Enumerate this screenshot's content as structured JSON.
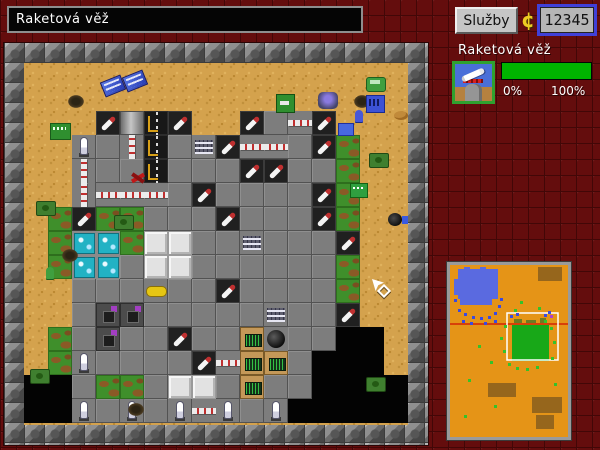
{
  "topbar": {
    "title_field": "Raketová věž",
    "services_button": "Služby",
    "coin_symbol": "¢",
    "money": "12345"
  },
  "panel": {
    "title": "Raketová věž",
    "icon": "missile-tower-icon",
    "progress_percent": 100,
    "progress_min_label": "0%",
    "progress_max_label": "100%",
    "bar_color": "#00b400"
  },
  "colors": {
    "background_brick": "#640d0d",
    "frame_block": "#8a8a8a",
    "sand": "#d4a24d",
    "money_border": "#4040d8",
    "icon_border": "#2fa12f",
    "minimap_ground": "#e59417",
    "minimap_water": "#5a6ae0",
    "minimap_zone": "#18a818",
    "minimap_line": "#d84008"
  },
  "map": {
    "tile_size": 24,
    "legend": {
      "g": "plate",
      "t": "turret",
      "m": "missile",
      "c": "camo",
      "v": "void",
      "f": "building-white",
      "F": "machine",
      "r": "runway",
      "p": "pipe-vertical",
      "P": "pipe-horizontal",
      "b": "console-blue",
      "w": "lab-cyan",
      "y": "vehicle-yellow",
      "T": "garage",
      "e": "control-panel",
      "o": "generator",
      "u": "barracks",
      "h": "manhole"
    },
    "rows": [
      "................",
      "................",
      "...tFrt..tgPt...",
      "..mgprgutPPgtc..",
      "..pggrgggttggc..",
      "..pPPPgtggggtc..",
      ".ctccgggtgggtc.h",
      ".cwwcffggugggt..",
      ".cwwgffggggggc..",
      "..gggyggtggggc..",
      "..gTTggggguggt..",
      ".cgTggtggeoggvv.",
      ".cmggggtPeegvvv.",
      "vvgccgffgeggvvvv",
      "vvmgmgmPmgmvvvvv"
    ],
    "sprites": [
      {
        "t": "crate",
        "x": 78,
        "y": 15
      },
      {
        "t": "crate",
        "x": 100,
        "y": 10
      },
      {
        "t": "shrub",
        "x": 44,
        "y": 32
      },
      {
        "t": "shrub",
        "x": 330,
        "y": 32
      },
      {
        "t": "shrub",
        "x": 38,
        "y": 186
      },
      {
        "t": "shrub",
        "x": 104,
        "y": 340
      },
      {
        "t": "bunker",
        "x": 26,
        "y": 60
      },
      {
        "t": "flag",
        "x": 252,
        "y": 31
      },
      {
        "t": "mech",
        "x": 294,
        "y": 29
      },
      {
        "t": "bldg",
        "x": 342,
        "y": 32
      },
      {
        "t": "truck",
        "x": 342,
        "y": 14
      },
      {
        "t": "soldier-blue",
        "x": 331,
        "y": 47
      },
      {
        "t": "vehicle-blue",
        "x": 314,
        "y": 60
      },
      {
        "t": "tank",
        "x": 345,
        "y": 90
      },
      {
        "t": "tank",
        "x": 12,
        "y": 138
      },
      {
        "t": "tank",
        "x": 90,
        "y": 152
      },
      {
        "t": "tank",
        "x": 342,
        "y": 314
      },
      {
        "t": "tank",
        "x": 6,
        "y": 306
      },
      {
        "t": "box",
        "x": 326,
        "y": 120
      },
      {
        "t": "dune",
        "x": 370,
        "y": 48
      },
      {
        "t": "bird",
        "x": 106,
        "y": 108
      },
      {
        "t": "soldier-green",
        "x": 22,
        "y": 204
      },
      {
        "t": "cursor",
        "x": 348,
        "y": 216
      }
    ]
  },
  "minimap": {
    "width": 118,
    "height": 172,
    "ground": "#e59417",
    "water_color": "#5a6ae0",
    "water_rects": [
      [
        8,
        4,
        40,
        30
      ],
      [
        10,
        34,
        32,
        6
      ],
      [
        4,
        14,
        4,
        16
      ],
      [
        14,
        2,
        6,
        4
      ],
      [
        30,
        2,
        6,
        4
      ]
    ],
    "patch_color": "#96661c",
    "patches": [
      [
        88,
        2,
        24,
        14
      ],
      [
        38,
        118,
        28,
        14
      ],
      [
        82,
        132,
        30,
        16
      ],
      [
        86,
        150,
        18,
        14
      ]
    ],
    "line_color": "#d84008",
    "line_y": 59,
    "viewport": {
      "x": 57,
      "y": 48,
      "w": 51,
      "h": 47
    },
    "zone": {
      "x": 62,
      "y": 58,
      "w": 37,
      "h": 38,
      "color": "#18a818"
    },
    "zone_fringe": [
      [
        64,
        54,
        8,
        4
      ],
      [
        76,
        55,
        10,
        3
      ],
      [
        90,
        53,
        6,
        5
      ]
    ],
    "green_dots": [
      [
        54,
        60
      ],
      [
        50,
        72
      ],
      [
        53,
        85
      ],
      [
        58,
        98
      ],
      [
        66,
        102
      ],
      [
        76,
        103
      ],
      [
        86,
        101
      ],
      [
        100,
        62
      ],
      [
        103,
        76
      ],
      [
        101,
        92
      ],
      [
        64,
        44
      ],
      [
        88,
        42
      ],
      [
        28,
        80
      ],
      [
        18,
        114
      ],
      [
        44,
        140
      ],
      [
        104,
        118
      ],
      [
        14,
        150
      ],
      [
        70,
        36
      ],
      [
        94,
        55
      ],
      [
        40,
        96
      ]
    ],
    "blue_dots": [
      [
        8,
        44
      ],
      [
        14,
        48
      ],
      [
        22,
        51
      ],
      [
        30,
        52
      ],
      [
        38,
        51
      ],
      [
        44,
        47
      ],
      [
        48,
        40
      ],
      [
        4,
        34
      ],
      [
        12,
        55
      ],
      [
        20,
        57
      ],
      [
        34,
        57
      ],
      [
        44,
        55
      ],
      [
        50,
        33
      ],
      [
        60,
        50
      ],
      [
        66,
        48
      ],
      [
        94,
        49
      ],
      [
        98,
        46
      ]
    ],
    "purple_dots": [
      [
        100,
        50
      ]
    ],
    "dot_size": 3
  }
}
